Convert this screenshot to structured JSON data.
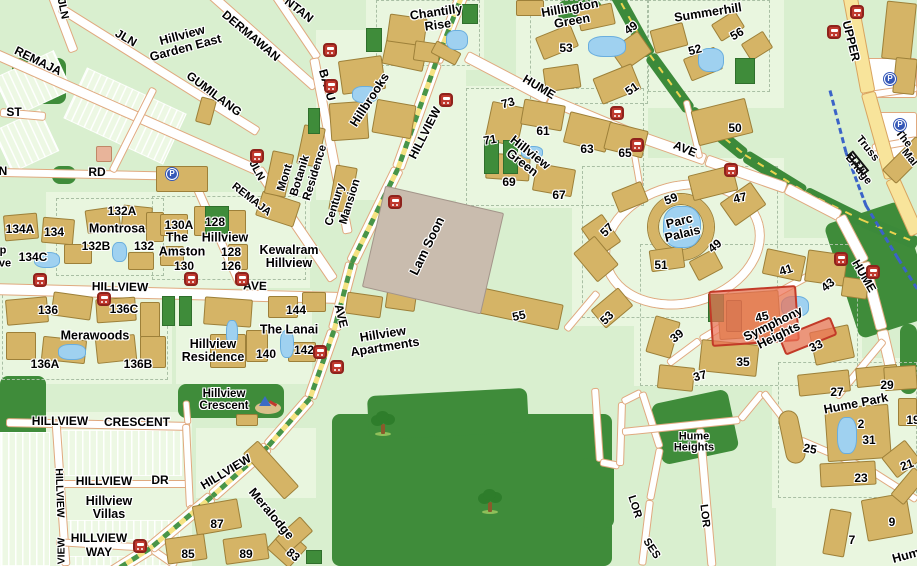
{
  "map": {
    "colors": {
      "background_green": "#d9efcf",
      "estate_green": "#e9f6df",
      "park_green": "#3f8c3a",
      "building_tan": "#d5b466",
      "industrial_gray": "#c9bcae",
      "road_white": "#ffffff",
      "road_border": "#e0a97f",
      "major_road_yellow": "#f8e49b",
      "water_blue": "#9fd1f0",
      "bus_icon_red": "#c0392e",
      "carpark_icon_blue": "#3558b8",
      "highlight_red": "#ec7055",
      "rail_dash_yellow": "#ead34e",
      "pipeline_dash_blue": "#3b63c4"
    },
    "selected_building": {
      "estate": "Symphony Heights",
      "unit_label": "45",
      "highlight_color": "#ec7055"
    },
    "street_labels": [
      {
        "text": "JLN",
        "x": 62,
        "y": 9,
        "rot": 78,
        "size": 11
      },
      {
        "text": "REMAJA",
        "x": 38,
        "y": 61,
        "rot": 26,
        "size": 12
      },
      {
        "text": "JLN",
        "x": 126,
        "y": 38,
        "rot": 30,
        "size": 12
      },
      {
        "text": "GUMILANG",
        "x": 214,
        "y": 94,
        "rot": 37,
        "size": 12
      },
      {
        "text": "DERMAWAN",
        "x": 251,
        "y": 36,
        "rot": 40,
        "size": 12
      },
      {
        "text": "NTAN",
        "x": 299,
        "y": 10,
        "rot": 38,
        "size": 12
      },
      {
        "text": "BATU",
        "x": 327,
        "y": 85,
        "rot": 74,
        "size": 12
      },
      {
        "text": "ST",
        "x": 14,
        "y": 112,
        "rot": 0,
        "size": 12
      },
      {
        "text": "N",
        "x": 3,
        "y": 171,
        "rot": 0,
        "size": 12
      },
      {
        "text": "RD",
        "x": 97,
        "y": 172,
        "rot": 0,
        "size": 12
      },
      {
        "text": "JLN",
        "x": 256,
        "y": 171,
        "rot": 62,
        "size": 11
      },
      {
        "text": "REMAJA",
        "x": 251,
        "y": 200,
        "rot": 38,
        "size": 11
      },
      {
        "text": "HILLVIEW",
        "x": 120,
        "y": 287,
        "rot": 1,
        "size": 12
      },
      {
        "text": "AVE",
        "x": 255,
        "y": 286,
        "rot": 2,
        "size": 12
      },
      {
        "text": "HILLVIEW",
        "x": 425,
        "y": 133,
        "rot": -63,
        "size": 12
      },
      {
        "text": "AVE",
        "x": 341,
        "y": 316,
        "rot": 76,
        "size": 12
      },
      {
        "text": "HILLVIEW",
        "x": 226,
        "y": 472,
        "rot": -31,
        "size": 12
      },
      {
        "text": "HUME",
        "x": 539,
        "y": 87,
        "rot": 31,
        "size": 12
      },
      {
        "text": "AVE",
        "x": 685,
        "y": 149,
        "rot": 22,
        "size": 12
      },
      {
        "text": "HUME",
        "x": 864,
        "y": 276,
        "rot": 60,
        "size": 12
      },
      {
        "text": "UPPER",
        "x": 851,
        "y": 41,
        "rot": 76,
        "size": 12
      },
      {
        "text": "HILLVIEW",
        "x": 60,
        "y": 421,
        "rot": 0,
        "size": 12
      },
      {
        "text": "CRESCENT",
        "x": 137,
        "y": 422,
        "rot": 0,
        "size": 12
      },
      {
        "text": "HILLVIEW",
        "x": 104,
        "y": 481,
        "rot": 0,
        "size": 12
      },
      {
        "text": "DR",
        "x": 160,
        "y": 480,
        "rot": 0,
        "size": 12
      },
      {
        "text": "HILLVIEW",
        "x": 99,
        "y": 538,
        "rot": 0,
        "size": 12
      },
      {
        "text": "WAY",
        "x": 99,
        "y": 552,
        "rot": 0,
        "size": 12
      },
      {
        "text": "HILLVIEW",
        "x": 59,
        "y": 493,
        "rot": 88,
        "size": 10.5
      },
      {
        "text": "VIEW",
        "x": 62,
        "y": 551,
        "rot": -90,
        "size": 10.5
      },
      {
        "text": "LOR",
        "x": 634,
        "y": 507,
        "rot": 72,
        "size": 11
      },
      {
        "text": "SES",
        "x": 651,
        "y": 549,
        "rot": 56,
        "size": 11
      },
      {
        "text": "LOR",
        "x": 704,
        "y": 516,
        "rot": 83,
        "size": 11
      },
      {
        "text": "Truss",
        "x": 867,
        "y": 149,
        "rot": 51,
        "size": 11
      },
      {
        "text": "Bridge",
        "x": 858,
        "y": 170,
        "rot": 51,
        "size": 11
      },
      {
        "text": "The",
        "x": 903,
        "y": 139,
        "rot": 51,
        "size": 11
      },
      {
        "text": "Mal",
        "x": 909,
        "y": 158,
        "rot": 51,
        "size": 11
      },
      {
        "text": "p",
        "x": 3,
        "y": 251,
        "rot": 0,
        "size": 11
      },
      {
        "text": "ve",
        "x": 5,
        "y": 264,
        "rot": 0,
        "size": 11
      }
    ],
    "place_labels": [
      {
        "lines": [
          "Hillview",
          "Garden East"
        ],
        "x": 184,
        "y": 42,
        "rot": -15,
        "size": 12.5
      },
      {
        "lines": [
          "Hillbrooks"
        ],
        "x": 370,
        "y": 100,
        "rot": -57,
        "size": 12.5
      },
      {
        "lines": [
          "Mont"
        ],
        "x": 286,
        "y": 178,
        "rot": -73,
        "size": 11.5
      },
      {
        "lines": [
          "Botanik"
        ],
        "x": 301,
        "y": 176,
        "rot": -73,
        "size": 11.5
      },
      {
        "lines": [
          "Residence"
        ],
        "x": 316,
        "y": 173,
        "rot": -73,
        "size": 11.5
      },
      {
        "lines": [
          "Century"
        ],
        "x": 336,
        "y": 205,
        "rot": -73,
        "size": 11.5
      },
      {
        "lines": [
          "Mansion"
        ],
        "x": 351,
        "y": 202,
        "rot": -73,
        "size": 11.5
      },
      {
        "lines": [
          "Chantilly",
          "Rise"
        ],
        "x": 437,
        "y": 19,
        "rot": -8,
        "size": 12.5
      },
      {
        "lines": [
          "Hillington",
          "Green"
        ],
        "x": 571,
        "y": 15,
        "rot": -10,
        "size": 12.5
      },
      {
        "lines": [
          "Summerhill"
        ],
        "x": 708,
        "y": 13,
        "rot": -9,
        "size": 12.5
      },
      {
        "lines": [
          "Hillview",
          "Green"
        ],
        "x": 526,
        "y": 158,
        "rot": 38,
        "size": 12.5
      },
      {
        "lines": [
          "Parc",
          "Palais"
        ],
        "x": 681,
        "y": 228,
        "rot": -14,
        "size": 12.5
      },
      {
        "lines": [
          "Symphony",
          "Heights"
        ],
        "x": 776,
        "y": 330,
        "rot": -26,
        "size": 12.5
      },
      {
        "lines": [
          "Hume Park"
        ],
        "x": 856,
        "y": 404,
        "rot": -11,
        "size": 12.5
      },
      {
        "lines": [
          "Hume",
          "Heights"
        ],
        "x": 694,
        "y": 443,
        "rot": 0,
        "size": 11
      },
      {
        "lines": [
          "Montrosa"
        ],
        "x": 117,
        "y": 229,
        "rot": 0,
        "size": 12.5
      },
      {
        "lines": [
          "The"
        ],
        "x": 177,
        "y": 238,
        "rot": 0,
        "size": 12.5
      },
      {
        "lines": [
          "Hillview"
        ],
        "x": 225,
        "y": 238,
        "rot": 0,
        "size": 12.5
      },
      {
        "lines": [
          "Amston"
        ],
        "x": 182,
        "y": 252,
        "rot": 0,
        "size": 12.5
      },
      {
        "lines": [
          "Kewalram",
          "Hillview"
        ],
        "x": 289,
        "y": 257,
        "rot": 0,
        "size": 12.5
      },
      {
        "lines": [
          "Merawoods"
        ],
        "x": 95,
        "y": 336,
        "rot": 0,
        "size": 12.5
      },
      {
        "lines": [
          "Hillview",
          "Residence"
        ],
        "x": 213,
        "y": 351,
        "rot": 0,
        "size": 12.5
      },
      {
        "lines": [
          "The Lanai"
        ],
        "x": 289,
        "y": 330,
        "rot": 0,
        "size": 12.5
      },
      {
        "lines": [
          "Hillview",
          "Apartments"
        ],
        "x": 384,
        "y": 341,
        "rot": -9,
        "size": 12.5
      },
      {
        "lines": [
          "Lam Soon"
        ],
        "x": 427,
        "y": 246,
        "rot": -64,
        "size": 13
      },
      {
        "lines": [
          "Hillview",
          "Villas"
        ],
        "x": 109,
        "y": 508,
        "rot": 0,
        "size": 12.5
      },
      {
        "lines": [
          "Hillview",
          "Crescent"
        ],
        "x": 224,
        "y": 401,
        "rot": 0,
        "size": 11.5
      },
      {
        "lines": [
          "Meralodge"
        ],
        "x": 271,
        "y": 514,
        "rot": 50,
        "size": 12.5
      },
      {
        "lines": [
          "Hum"
        ],
        "x": 906,
        "y": 556,
        "rot": -15,
        "size": 12.5
      }
    ],
    "number_labels": [
      {
        "text": "134A",
        "x": 20,
        "y": 229,
        "rot": 0
      },
      {
        "text": "134",
        "x": 54,
        "y": 232,
        "rot": 0
      },
      {
        "text": "134C",
        "x": 33,
        "y": 257,
        "rot": 0
      },
      {
        "text": "132A",
        "x": 122,
        "y": 211,
        "rot": 0
      },
      {
        "text": "132B",
        "x": 96,
        "y": 246,
        "rot": 0
      },
      {
        "text": "132",
        "x": 144,
        "y": 246,
        "rot": 0
      },
      {
        "text": "130A",
        "x": 179,
        "y": 225,
        "rot": 0
      },
      {
        "text": "128",
        "x": 215,
        "y": 222,
        "rot": 0
      },
      {
        "text": "128",
        "x": 231,
        "y": 252,
        "rot": 0
      },
      {
        "text": "130",
        "x": 184,
        "y": 266,
        "rot": 0
      },
      {
        "text": "126",
        "x": 231,
        "y": 266,
        "rot": 0
      },
      {
        "text": "136",
        "x": 48,
        "y": 310,
        "rot": 0
      },
      {
        "text": "136C",
        "x": 124,
        "y": 309,
        "rot": 0
      },
      {
        "text": "136A",
        "x": 45,
        "y": 364,
        "rot": 0
      },
      {
        "text": "136B",
        "x": 138,
        "y": 364,
        "rot": 0
      },
      {
        "text": "144",
        "x": 296,
        "y": 310,
        "rot": 0
      },
      {
        "text": "140",
        "x": 266,
        "y": 354,
        "rot": 0
      },
      {
        "text": "142",
        "x": 304,
        "y": 350,
        "rot": 0
      },
      {
        "text": "87",
        "x": 217,
        "y": 524,
        "rot": 0
      },
      {
        "text": "85",
        "x": 188,
        "y": 554,
        "rot": 0
      },
      {
        "text": "89",
        "x": 246,
        "y": 554,
        "rot": 0
      },
      {
        "text": "83",
        "x": 293,
        "y": 555,
        "rot": 40
      },
      {
        "text": "53",
        "x": 566,
        "y": 48,
        "rot": 0
      },
      {
        "text": "49",
        "x": 631,
        "y": 28,
        "rot": -35
      },
      {
        "text": "51",
        "x": 632,
        "y": 89,
        "rot": -35
      },
      {
        "text": "52",
        "x": 695,
        "y": 50,
        "rot": -15
      },
      {
        "text": "56",
        "x": 737,
        "y": 34,
        "rot": -30
      },
      {
        "text": "50",
        "x": 735,
        "y": 128,
        "rot": 0
      },
      {
        "text": "73",
        "x": 508,
        "y": 103,
        "rot": -15
      },
      {
        "text": "71",
        "x": 490,
        "y": 140,
        "rot": -10
      },
      {
        "text": "61",
        "x": 543,
        "y": 131,
        "rot": 0
      },
      {
        "text": "63",
        "x": 587,
        "y": 149,
        "rot": 0
      },
      {
        "text": "65",
        "x": 625,
        "y": 153,
        "rot": 0
      },
      {
        "text": "69",
        "x": 509,
        "y": 182,
        "rot": 0
      },
      {
        "text": "67",
        "x": 559,
        "y": 195,
        "rot": 0
      },
      {
        "text": "55",
        "x": 519,
        "y": 316,
        "rot": -12
      },
      {
        "text": "59",
        "x": 671,
        "y": 199,
        "rot": -20
      },
      {
        "text": "47",
        "x": 740,
        "y": 198,
        "rot": -12
      },
      {
        "text": "57",
        "x": 607,
        "y": 230,
        "rot": -45
      },
      {
        "text": "49",
        "x": 715,
        "y": 246,
        "rot": -40
      },
      {
        "text": "51",
        "x": 661,
        "y": 265,
        "rot": 0
      },
      {
        "text": "53",
        "x": 607,
        "y": 318,
        "rot": -45
      },
      {
        "text": "41",
        "x": 786,
        "y": 270,
        "rot": -18
      },
      {
        "text": "43",
        "x": 828,
        "y": 285,
        "rot": -40
      },
      {
        "text": "39",
        "x": 677,
        "y": 336,
        "rot": -40
      },
      {
        "text": "45",
        "x": 762,
        "y": 317,
        "rot": -12
      },
      {
        "text": "33",
        "x": 816,
        "y": 346,
        "rot": -25
      },
      {
        "text": "35",
        "x": 743,
        "y": 362,
        "rot": 0
      },
      {
        "text": "37",
        "x": 700,
        "y": 376,
        "rot": -15
      },
      {
        "text": "27",
        "x": 837,
        "y": 392,
        "rot": 0
      },
      {
        "text": "29",
        "x": 887,
        "y": 385,
        "rot": 0
      },
      {
        "text": "2",
        "x": 861,
        "y": 424,
        "rot": 0
      },
      {
        "text": "31",
        "x": 869,
        "y": 440,
        "rot": 0
      },
      {
        "text": "25",
        "x": 810,
        "y": 449,
        "rot": 10
      },
      {
        "text": "23",
        "x": 861,
        "y": 478,
        "rot": 0
      },
      {
        "text": "21",
        "x": 907,
        "y": 465,
        "rot": -20
      },
      {
        "text": "19",
        "x": 913,
        "y": 420,
        "rot": 0
      },
      {
        "text": "9",
        "x": 892,
        "y": 522,
        "rot": 0
      },
      {
        "text": "7",
        "x": 852,
        "y": 540,
        "rot": 0
      }
    ],
    "icons": {
      "bus_stops": [
        [
          40,
          280
        ],
        [
          104,
          299
        ],
        [
          191,
          279
        ],
        [
          242,
          279
        ],
        [
          257,
          156
        ],
        [
          330,
          50
        ],
        [
          331,
          86
        ],
        [
          395,
          202
        ],
        [
          446,
          100
        ],
        [
          617,
          113
        ],
        [
          637,
          145
        ],
        [
          731,
          170
        ],
        [
          841,
          259
        ],
        [
          873,
          272
        ],
        [
          857,
          12
        ],
        [
          834,
          32
        ],
        [
          320,
          352
        ],
        [
          337,
          367
        ],
        [
          140,
          546
        ]
      ],
      "car_parks": [
        [
          172,
          174
        ],
        [
          890,
          79
        ],
        [
          900,
          125
        ]
      ],
      "trees": [
        [
          383,
          424
        ],
        [
          490,
          502
        ]
      ],
      "playgrounds": [
        [
          268,
          405
        ]
      ],
      "bridges": [
        [
          858,
          163
        ]
      ]
    }
  }
}
